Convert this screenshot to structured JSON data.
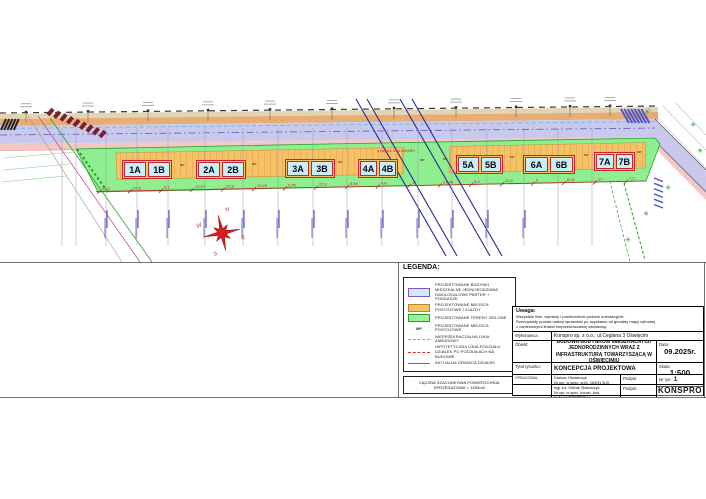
{
  "plan": {
    "strefa_label": "STREFA OSŁONOWA",
    "mp_label": "MP",
    "compass": {
      "n": "N",
      "e": "E",
      "s": "S",
      "w": "W"
    },
    "buildings": [
      {
        "a": "1A",
        "b": "1B"
      },
      {
        "a": "2A",
        "b": "2B"
      },
      {
        "a": "3A",
        "b": "3B"
      },
      {
        "a": "4A",
        "b": "4B"
      },
      {
        "a": "5A",
        "b": "5B"
      },
      {
        "a": "6A",
        "b": "6B"
      },
      {
        "a": "7A",
        "b": "7B"
      }
    ],
    "dimensions": [
      "10,3",
      "22,8",
      "6,1",
      "10,15",
      "22,8",
      "10,25",
      "9,45",
      "22,8",
      "9,55",
      "4,8",
      "17",
      "21,45",
      "8,9",
      "22,8",
      "6",
      "8,25",
      "17",
      "7,2"
    ]
  },
  "legend": {
    "title": "LEGENDA:",
    "items": [
      {
        "swatch": "building",
        "label": "PROJEKTOWANE BUDYNKI MIESZKALNE JEDNORODZINNE DWULOKALOWE PARTER + PODDASZE"
      },
      {
        "swatch": "parking",
        "label": "PROJEKTOWANE MIEJSCA POSTOJOWE I ZJAZDY"
      },
      {
        "swatch": "green",
        "label": "PROJEKTOWANE TERENY ZIELONE"
      },
      {
        "swatch": "mp",
        "swatch_text": "MP",
        "label": "PROJEKTOWANE MIEJSCA POSTOJOWE"
      },
      {
        "swatch": "line-cyan",
        "label": "NIEPRZEKRACZALNA LINIA ZABUDOWY"
      },
      {
        "swatch": "line-red",
        "label": "HIPOTETYCZNA LINIA PODZIAŁU DZIAŁEK PO PODZIAŁACH NA BUDOWIE"
      },
      {
        "swatch": "line-green",
        "label": "AKTUALNA GRANICA DZIAŁEK"
      }
    ],
    "summary": "ŁĄCZNA SZACUNKOWA POWIERZCHNIA SPRZEDAŻOWA = 1594m2"
  },
  "titleblock": {
    "note_title": "Uwaga:",
    "note_line1": "Wszystkie linie, wymiary i powierzchnie podane orientacyjnie.",
    "note_line2": "Rzeczywisty pomiar należy sprawdzić po uzyskaniu od geodety mapy cyfrowej",
    "note_line3": "z naniesionymi liniami nieprzekraczalnej zabudowy.",
    "wykonawca_label": "Wykonawca:",
    "wykonawca": "Konspro sp. z o.o.; ul.Ceglana 3 Oświęcim",
    "obiekt_label": "Obiekt:",
    "obiekt": "BUDOWA BUDYNKÓW MIESZKALNYCH JEDNORODZINNYCH WRAZ Z INFRASTRUKTURĄ TOWARZYSZĄCĄ W OŚWIĘCIMIU",
    "data_label": "Data:",
    "data_value": "09.2025r.",
    "tytul_label": "Tytuł rysunku:",
    "tytul_value": "KONCEPCJA PROJEKTOWA",
    "skala_label": "Skala:",
    "skala_value": "1:500",
    "opracowal_label": "OPRACOWAŁ:",
    "author1_name": "Dariusz Obstarczyk",
    "author1_lic": "Nr upr. w spec. arch. 164/91 B-B",
    "author2_name": "mgr inż. Michał Obstarczyk",
    "author2_lic": "Nr upr. w spec. konstr.-bud. SLK/7028/PWBKb/17",
    "podpis_label": "Podpis:",
    "nr_rys_label": "Nr rys.:",
    "nr_rys_value": "1",
    "logo": "KONSPRO"
  },
  "colors": {
    "accent_red": "#c1272d",
    "building_fill": "#c9eef7",
    "green_area": "#8fee8f",
    "parking_orange": "#f6c268",
    "road_blue": "#c9c9ec",
    "road_pink": "#f2c8c4",
    "power_line_blue": "#2a2a99"
  }
}
